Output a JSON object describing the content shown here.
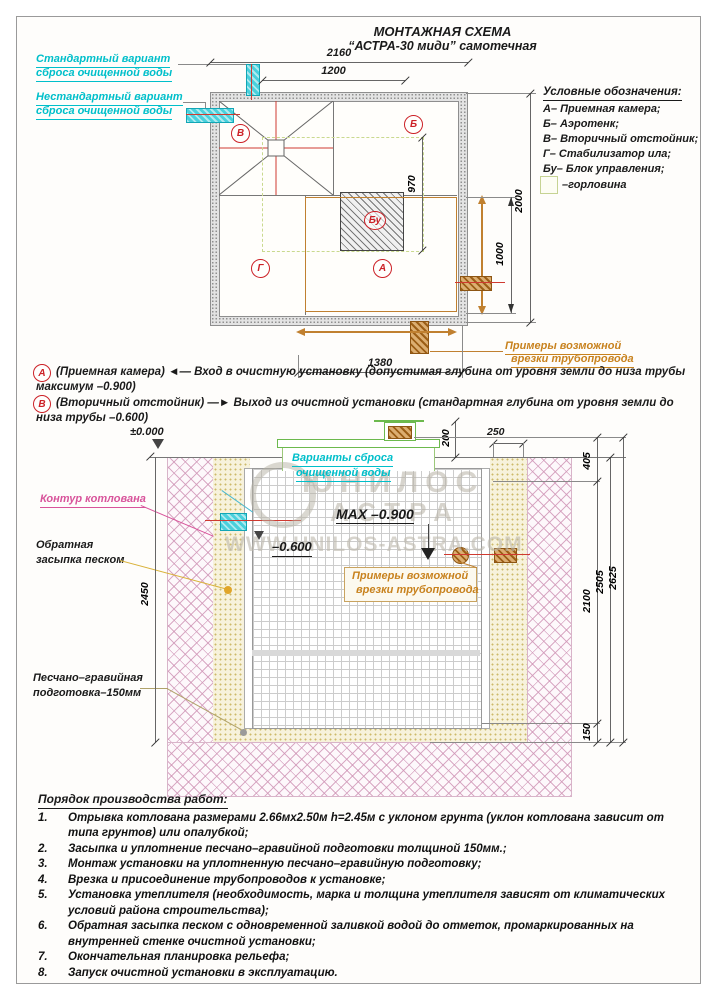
{
  "title": {
    "line1": "МОНТАЖНАЯ СХЕМА",
    "line2": "“АСТРА-30 миди” самотечная"
  },
  "outfall_labels": {
    "standard_1": "Стандартный вариант",
    "standard_2": "сброса очищенной воды",
    "nonstandard_1": "Нестандартный вариант",
    "nonstandard_2": "сброса очищенной воды"
  },
  "legend": {
    "heading": "Условные обозначения:",
    "items": [
      "А– Приемная камера;",
      "Б– Аэротенк;",
      "В– Вторичный отстойник;",
      "Г– Стабилизатор ила;",
      "Бу– Блок управления;"
    ],
    "gorlovina": "–горловина"
  },
  "plan": {
    "markers": {
      "v": "В",
      "b": "Б",
      "bu": "Бу",
      "g": "Г",
      "a": "А"
    },
    "dims": {
      "w_total": "2160",
      "w_inner": "1200",
      "h_bu": "970",
      "h_total": "2000",
      "h_half": "1000",
      "w_bottom": "1380"
    },
    "pipe_note_1": "Примеры возможной",
    "pipe_note_2": "врезки трубопровода"
  },
  "notes": {
    "a_marker": "А",
    "a_line1": "(Приемная камера) ◄— Вход в очистную установку (допустимая глубина от уровня земли до низа трубы",
    "a_line2": "максимум –0.900)",
    "b_marker": "В",
    "b_line1": "(Вторичный отстойник) —► Выход из очистной установки (стандартная глубина от уровня земли до",
    "b_line2": "низа трубы –0.600)"
  },
  "section": {
    "zero_level": "±0.000",
    "discharge_1": "Варианты сброса",
    "discharge_2": "очищенной воды",
    "max_level": "MAX –0.900",
    "out_level": "–0.600",
    "pit_label": "Контур котлована",
    "backfill_1": "Обратная",
    "backfill_2": "засыпка песком",
    "prep_1": "Песчано–гравийная",
    "prep_2": "подготовка–150мм",
    "pipe_note_1": "Примеры возможной",
    "pipe_note_2": "врезки трубопровода",
    "dims": {
      "d250": "250",
      "d200": "200",
      "d405": "405",
      "d2450": "2450",
      "d2100": "2100",
      "d2505": "2505",
      "d2625": "2625",
      "d150": "150"
    }
  },
  "watermark": {
    "line1": "ЮНИЛОС",
    "line2": "АСТРА",
    "url": "WWW.UNILOS-ASTRA.COM"
  },
  "work_order": {
    "heading": "Порядок производства работ:",
    "items": [
      {
        "num": "1.",
        "text": "Отрывка котлована размерами 2.66мх2.50м h=2.45м с уклоном грунта (уклон котлована зависит от типа грунтов) или опалубкой;"
      },
      {
        "num": "2.",
        "text": "Засыпка и уплотнение песчано–гравийной подготовки толщиной 150мм.;"
      },
      {
        "num": "3.",
        "text": "Монтаж установки на уплотненную песчано–гравийную подготовку;"
      },
      {
        "num": "4.",
        "text": "Врезка и присоединение трубопроводов к установке;"
      },
      {
        "num": "5.",
        "text": "Установка утеплителя (необходимость, марка и толщина утеплителя зависят от климатических условий района строительства);"
      },
      {
        "num": "6.",
        "text": "Обратная засыпка песком с одновременной заливкой водой до отметок, промаркированных на внутренней стенке очистной установки;"
      },
      {
        "num": "7.",
        "text": "Окончательная планировка рельефа;"
      },
      {
        "num": "8.",
        "text": "Запуск очистной установки в эксплуатацию."
      }
    ]
  }
}
